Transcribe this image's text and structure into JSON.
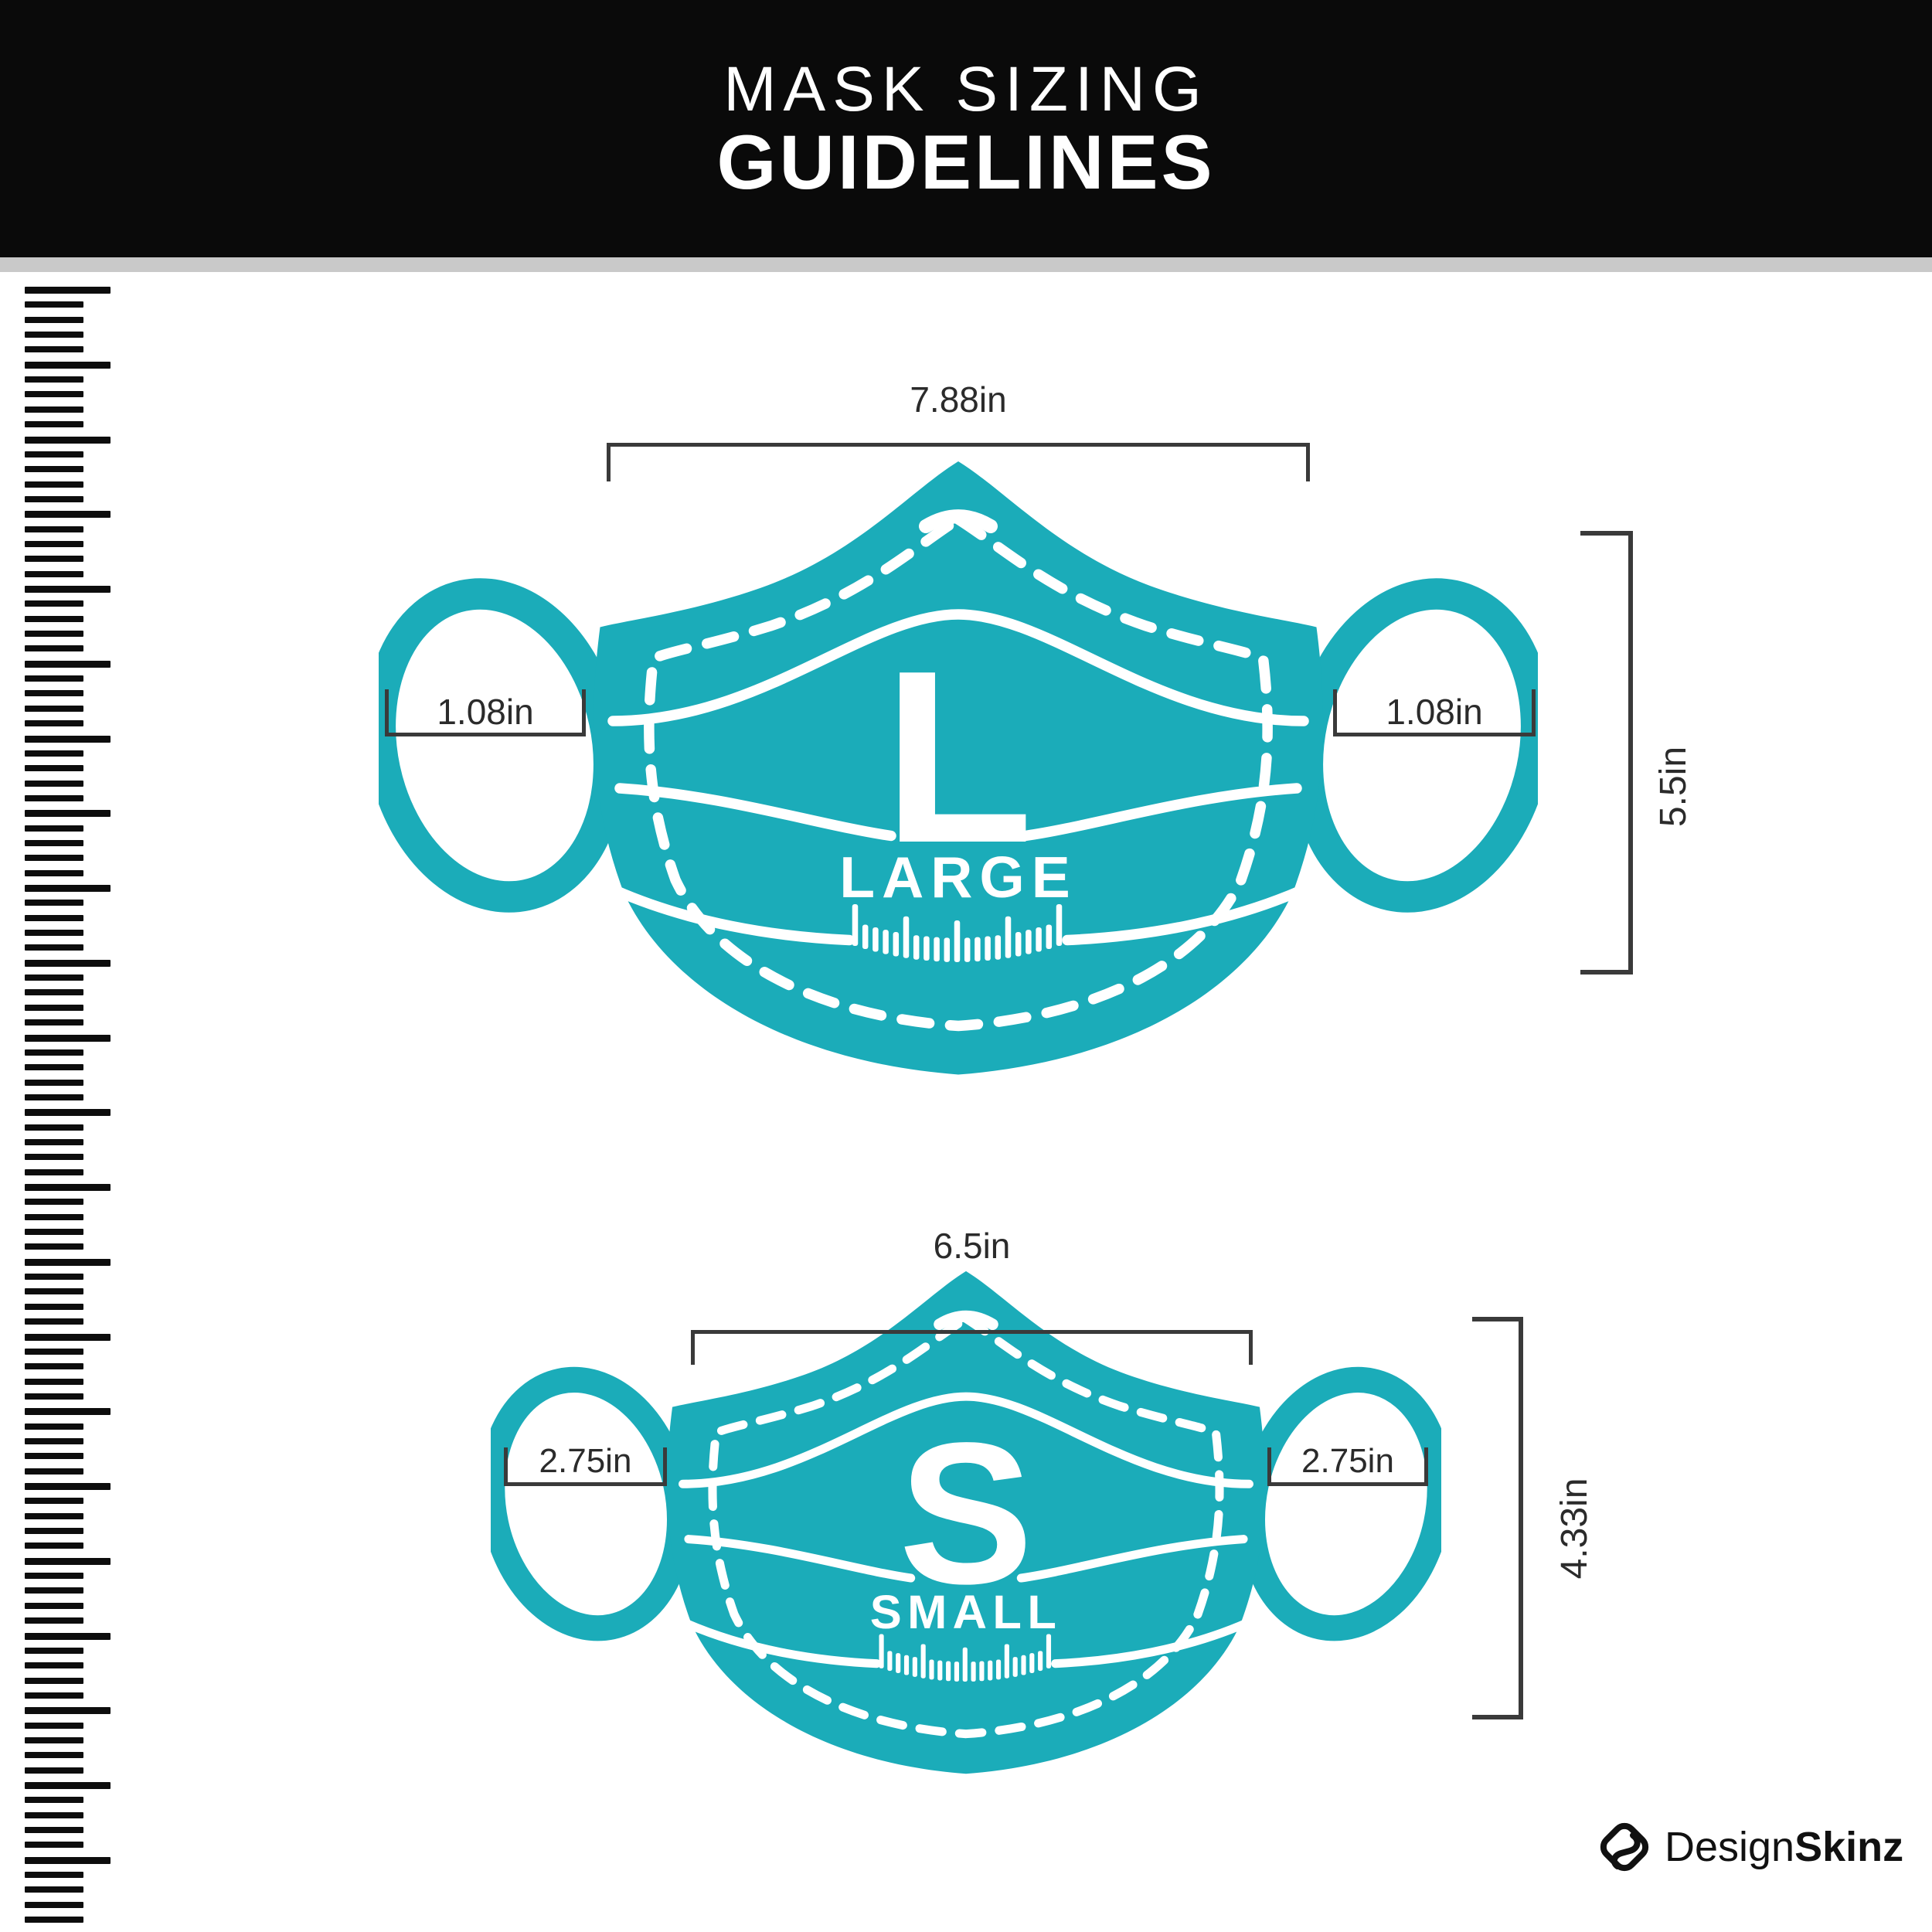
{
  "header": {
    "title_line1": "MASK SIZING",
    "title_line2": "GUIDELINES"
  },
  "masks": {
    "large": {
      "letter": "L",
      "size_name": "LARGE",
      "width": "7.88in",
      "ear_left": "1.08in",
      "ear_right": "1.08in",
      "height": "5.5in"
    },
    "small": {
      "letter": "S",
      "size_name": "SMALL",
      "width": "6.5in",
      "ear_left": "2.75in",
      "ear_right": "2.75in",
      "height": "4.33in"
    }
  },
  "footer": {
    "brand_regular": "Design",
    "brand_bold": "Skinz"
  },
  "colors": {
    "mask_teal": "#1bacb9",
    "header_bg": "#0a0a0a",
    "divider_gray": "#c9c9c9",
    "annotation_dark": "#3a3a3a"
  }
}
